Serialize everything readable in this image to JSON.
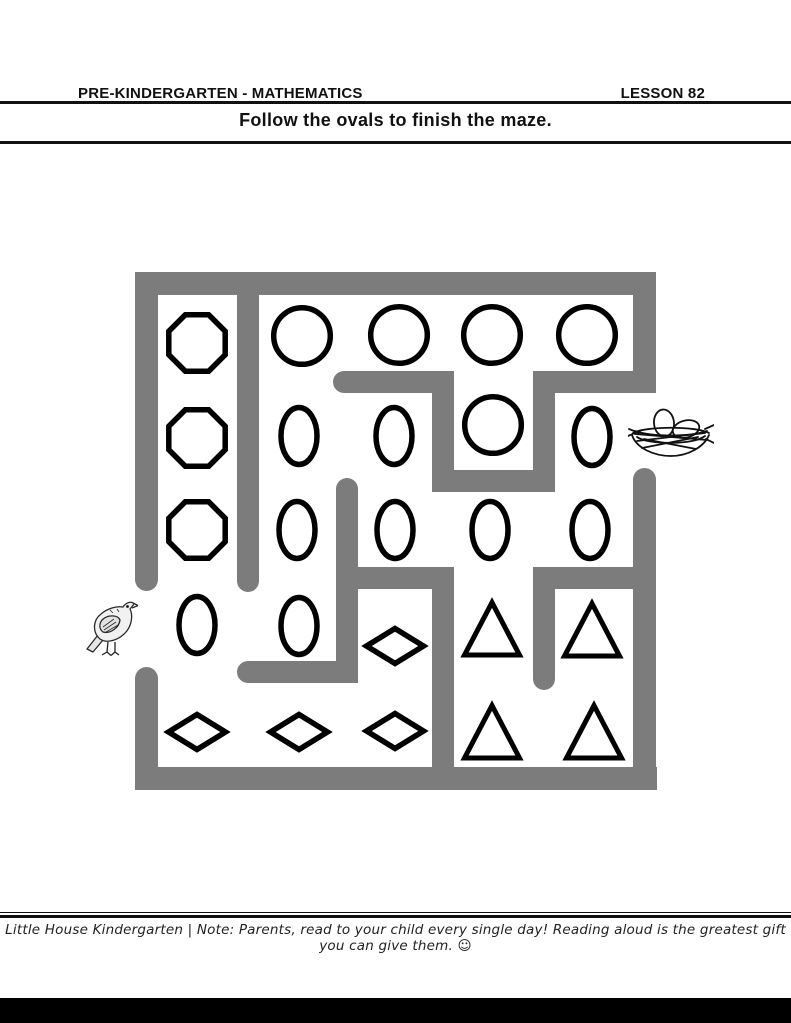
{
  "header": {
    "left_label": "PRE-KINDERGARTEN - MATHEMATICS",
    "right_label": "LESSON 82"
  },
  "instruction": {
    "text": "Follow the ovals to finish the maze."
  },
  "maze": {
    "wall_color": "#7c7c7c",
    "shape_stroke_color": "#000000",
    "shape_fill_color": "#ffffff",
    "start_icon": "bird",
    "end_icon": "nest-with-eggs",
    "walls": [
      {
        "x": 135,
        "y": 272,
        "w": 521,
        "h": 23,
        "caps": "none"
      },
      {
        "x": 135,
        "y": 272,
        "w": 23,
        "h": 319,
        "caps": "bottom"
      },
      {
        "x": 135,
        "y": 667,
        "w": 23,
        "h": 123,
        "caps": "top"
      },
      {
        "x": 135,
        "y": 767,
        "w": 522,
        "h": 23,
        "caps": "none"
      },
      {
        "x": 633,
        "y": 272,
        "w": 23,
        "h": 121,
        "caps": "none"
      },
      {
        "x": 633,
        "y": 468,
        "w": 23,
        "h": 322,
        "caps": "top"
      },
      {
        "x": 237,
        "y": 272,
        "w": 22,
        "h": 320,
        "caps": "bottom"
      },
      {
        "x": 333,
        "y": 371,
        "w": 121,
        "h": 22,
        "caps": "left"
      },
      {
        "x": 432,
        "y": 371,
        "w": 22,
        "h": 121,
        "caps": "none"
      },
      {
        "x": 432,
        "y": 470,
        "w": 123,
        "h": 22,
        "caps": "none"
      },
      {
        "x": 533,
        "y": 371,
        "w": 22,
        "h": 121,
        "caps": "none"
      },
      {
        "x": 533,
        "y": 371,
        "w": 123,
        "h": 22,
        "caps": "none"
      },
      {
        "x": 336,
        "y": 478,
        "w": 22,
        "h": 205,
        "caps": "top"
      },
      {
        "x": 336,
        "y": 567,
        "w": 118,
        "h": 22,
        "caps": "none"
      },
      {
        "x": 432,
        "y": 567,
        "w": 22,
        "h": 223,
        "caps": "none"
      },
      {
        "x": 237,
        "y": 661,
        "w": 121,
        "h": 22,
        "caps": "left"
      },
      {
        "x": 533,
        "y": 567,
        "w": 123,
        "h": 22,
        "caps": "none"
      },
      {
        "x": 533,
        "y": 567,
        "w": 22,
        "h": 123,
        "caps": "bottom"
      }
    ],
    "shapes": [
      {
        "type": "octagon",
        "cx": 197,
        "cy": 343
      },
      {
        "type": "circle",
        "cx": 302,
        "cy": 336
      },
      {
        "type": "circle",
        "cx": 399,
        "cy": 335
      },
      {
        "type": "circle",
        "cx": 492,
        "cy": 335
      },
      {
        "type": "circle",
        "cx": 587,
        "cy": 335
      },
      {
        "type": "octagon",
        "cx": 197,
        "cy": 438
      },
      {
        "type": "oval",
        "cx": 299,
        "cy": 436
      },
      {
        "type": "oval",
        "cx": 394,
        "cy": 436
      },
      {
        "type": "circle",
        "cx": 493,
        "cy": 425
      },
      {
        "type": "oval",
        "cx": 592,
        "cy": 437
      },
      {
        "type": "octagon",
        "cx": 197,
        "cy": 530
      },
      {
        "type": "oval",
        "cx": 297,
        "cy": 530
      },
      {
        "type": "oval",
        "cx": 395,
        "cy": 530
      },
      {
        "type": "oval",
        "cx": 490,
        "cy": 530
      },
      {
        "type": "oval",
        "cx": 590,
        "cy": 530
      },
      {
        "type": "oval",
        "cx": 197,
        "cy": 625
      },
      {
        "type": "oval",
        "cx": 299,
        "cy": 626
      },
      {
        "type": "diamond",
        "cx": 395,
        "cy": 646
      },
      {
        "type": "triangle",
        "cx": 492,
        "cy": 630
      },
      {
        "type": "triangle",
        "cx": 592,
        "cy": 631
      },
      {
        "type": "diamond",
        "cx": 197,
        "cy": 732
      },
      {
        "type": "diamond",
        "cx": 299,
        "cy": 732
      },
      {
        "type": "diamond",
        "cx": 395,
        "cy": 731
      },
      {
        "type": "triangle",
        "cx": 492,
        "cy": 733
      },
      {
        "type": "triangle",
        "cx": 594,
        "cy": 733
      }
    ]
  },
  "footer": {
    "note": "Little House Kindergarten | Note: Parents, read to your child every single day! Reading aloud is the greatest gift you can give them. ☺"
  }
}
